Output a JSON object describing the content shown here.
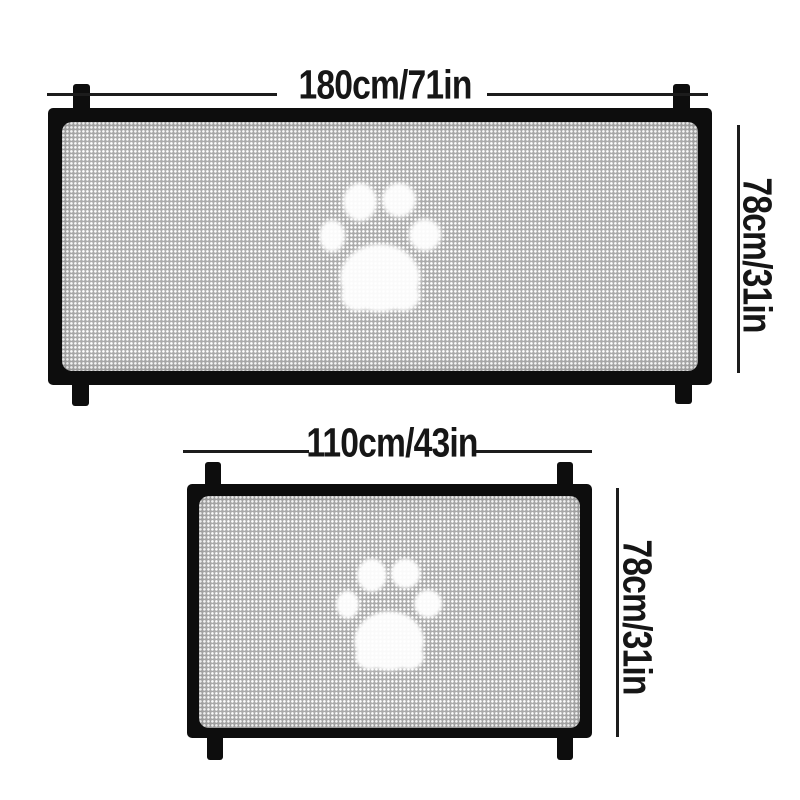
{
  "title": "Pet safety mesh gate size diagram",
  "colors": {
    "background": "#ffffff",
    "frame": "#0d0d0d",
    "line": "#1c1c1c",
    "text": "#161616",
    "mesh_base": "#ababab",
    "mesh_dot": "#ffffff",
    "paw": "#ffffff"
  },
  "gates": [
    {
      "name": "large-gate",
      "width_label": "180cm/71in",
      "height_label": "78cm/31in",
      "decoration": "paw-print"
    },
    {
      "name": "small-gate",
      "width_label": "110cm/43in",
      "height_label": "78cm/31in",
      "decoration": "paw-print"
    }
  ],
  "icons": [
    {
      "name": "paw-print-icon",
      "meaning": "dog paw print woven into mesh"
    }
  ]
}
